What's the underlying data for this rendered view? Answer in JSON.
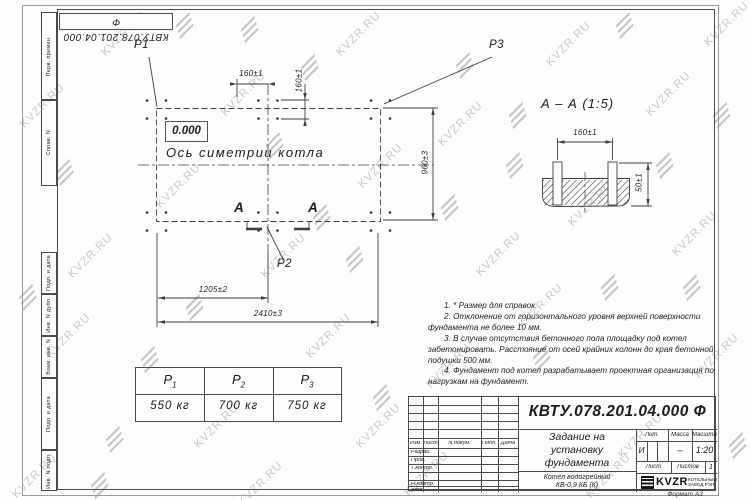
{
  "watermark": {
    "text": "KVZR.RU"
  },
  "frame": {
    "top_stamp": "КВТУ.078.201.04.000 Ф",
    "margin_labels": [
      "Перв. примен.",
      "Справ. N",
      "Подп. и дата",
      "Инв. N дубл.",
      "Взам. инв. N",
      "Подп. и дата",
      "Инв. N подл."
    ],
    "format_label": "Формат А3"
  },
  "plan": {
    "point_labels": {
      "p1": "P1",
      "p2": "P2",
      "p3": "P3"
    },
    "level_mark": "0.000",
    "axis_label": "Ось симетрии котла",
    "section_letter_left": "А",
    "section_letter_right": "А",
    "dimensions": {
      "bolt_spacing_h": "160±1",
      "bolt_spacing_v": "160±1",
      "width": "960±3",
      "half_length": "1205±2",
      "length": "2410±3"
    }
  },
  "section_view": {
    "title": "А – А (1:5)",
    "dim_bolt_spacing": "160±1",
    "dim_height": "50±1"
  },
  "notes": [
    "1. * Размер для справок.",
    "2. Отклонение от горизонтального уровня верхней поверхности фундамента не более 10 мм.",
    "3. В случае отсутствия бетонного пола площадку под котел забетонировать. Расстояние от осей крайних колонн до края бетонной подушки 500 мм.",
    "4. Фундамент под котел разрабатывает проектная организация по нагрузкам на фундамент."
  ],
  "load_table": {
    "headers": [
      {
        "base": "P",
        "sub": "1"
      },
      {
        "base": "P",
        "sub": "2"
      },
      {
        "base": "P",
        "sub": "3"
      }
    ],
    "values": [
      "550 кг",
      "700 кг",
      "750 кг"
    ]
  },
  "title_block": {
    "doc_number": "КВТУ.078.201.04.000 Ф",
    "title_lines": [
      "Задание на",
      "установку",
      "фундамента"
    ],
    "product_lines": [
      "Котел водогрейный",
      "КВ-0,9 КБ (К)"
    ],
    "columns": {
      "izm": "Изм.",
      "list": "Лист",
      "doc": "N докум.",
      "podp": "Подп.",
      "data": "Дата"
    },
    "rows": {
      "razrab": "Разраб.",
      "prov": "Пров.",
      "tkontr": "Т.контр.",
      "nkontr": "Н.контр.",
      "utv": "Утв."
    },
    "right": {
      "lit_label": "Лит.",
      "massa_label": "Масса",
      "masshtab_label": "Масштаб",
      "lit_value": "И",
      "massa_value": "–",
      "masshtab_value": "1:20",
      "list_label": "Лист",
      "listov_label": "Листов",
      "listov_value": "1"
    },
    "logo": {
      "name": "KVZR",
      "org_line1": "КОТЕЛЬНЫЙ",
      "org_line2": "ЗАВОД РЭП"
    }
  }
}
